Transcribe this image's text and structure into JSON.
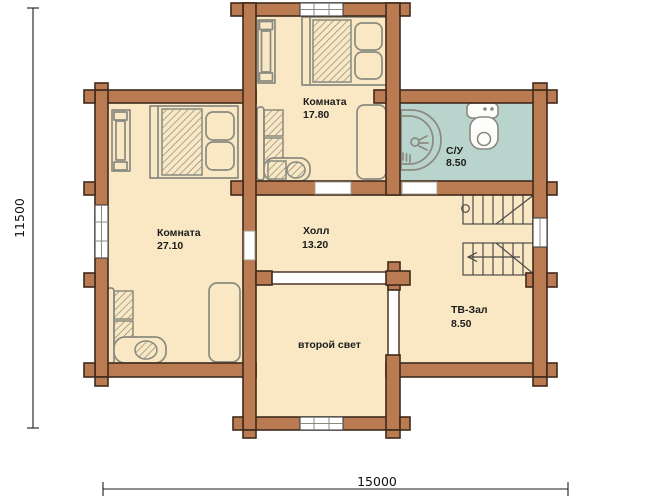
{
  "plan": {
    "rooms": {
      "bedroom_top": {
        "name": "Комната",
        "area": "17.80"
      },
      "bathroom": {
        "name": "С/У",
        "area": "8.50"
      },
      "bedroom_left": {
        "name": "Комната",
        "area": "27.10"
      },
      "hall": {
        "name": "Холл",
        "area": "13.20"
      },
      "tv_room": {
        "name": "ТВ-Зал",
        "area": "8.50"
      },
      "second_light": {
        "name": "второй свет"
      }
    },
    "dimensions": {
      "horizontal": "15000",
      "vertical": "11500"
    },
    "colors": {
      "wall": "#ba7b52",
      "floor": "#f9e8c3",
      "bathroom_floor": "#b9d4cd",
      "outline": "#3f2a1c",
      "furniture": "#8a8a80"
    },
    "symbols": [
      "double-bed",
      "wardrobe",
      "corner-sofa",
      "couch",
      "shower",
      "toilet",
      "sink",
      "stairs",
      "window",
      "door-opening",
      "railing"
    ]
  }
}
